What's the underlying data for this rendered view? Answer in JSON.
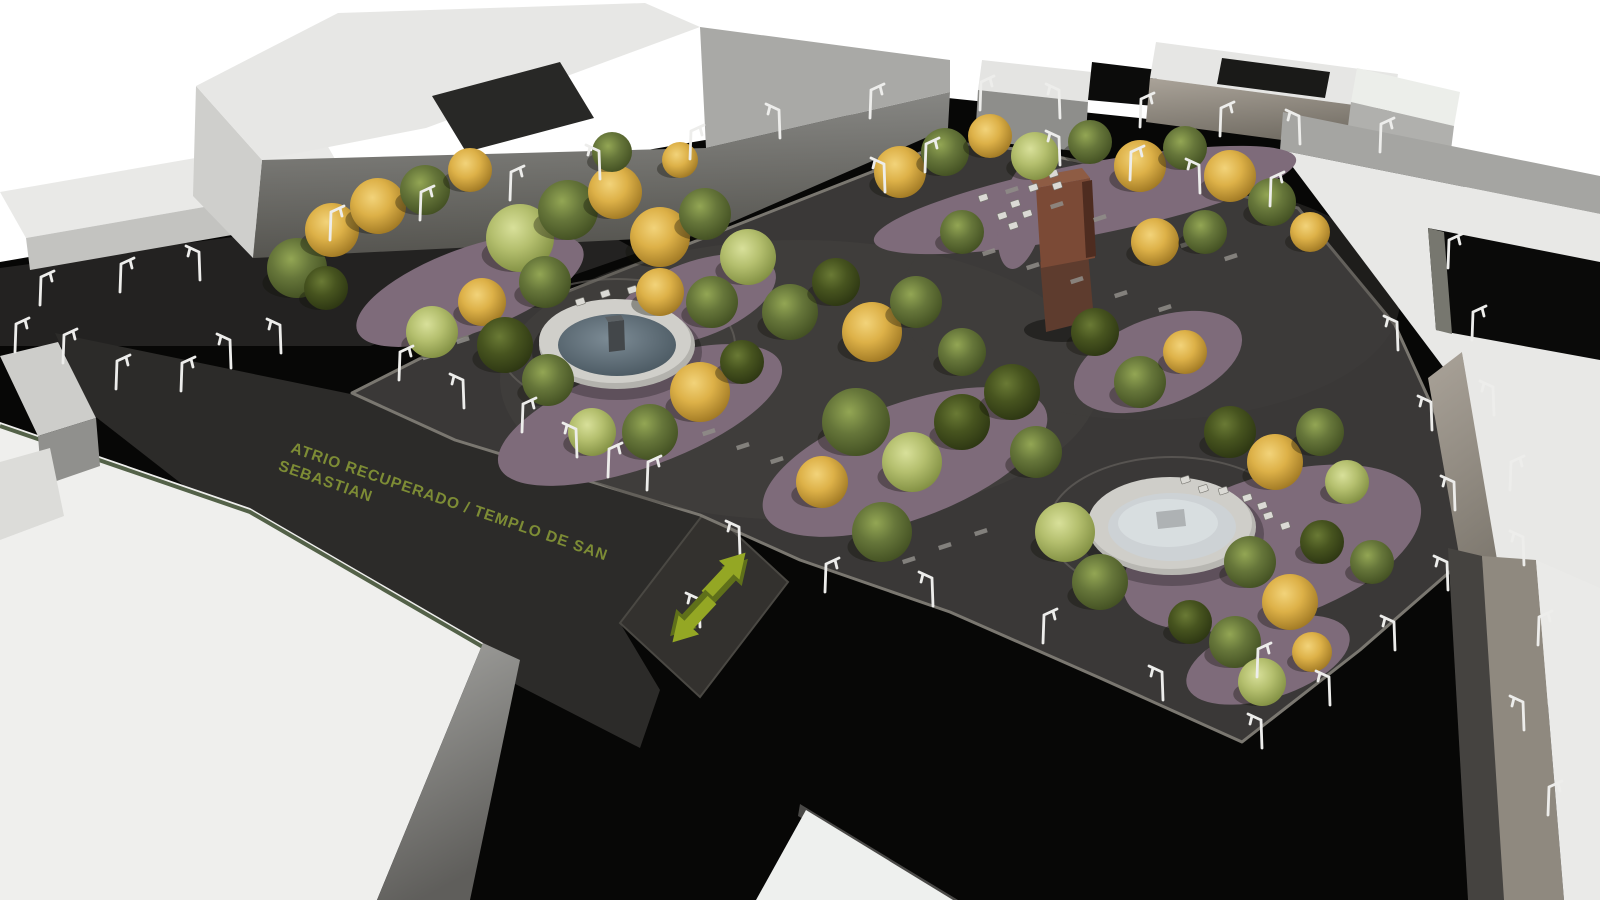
{
  "annotation": {
    "line1": "ATRIO RECUPERADO / TEMPLO DE SAN",
    "line2": "SEBASTIAN",
    "text_color": "#7d8c35"
  },
  "icons": {
    "arrow_up_right": "direction-arrow-northeast",
    "arrow_down_left": "direction-arrow-southwest",
    "street_lamp": "street-lamp"
  },
  "palette": {
    "background": "#ffffff",
    "street_asphalt": "#070706",
    "parking_surface": "#232221",
    "atrium_surface": "#2c2b29",
    "plaza_surface": "#3a3837",
    "crossing_surface": "#33312e",
    "curb_light": "#7a7770",
    "planting_bed": "#7e6b7a",
    "building_roof_white": "#eaeae8",
    "building_face_gray": "#8d8d8a",
    "building_face_taupe": "#9a948c",
    "fountain_rim": "#cfcec9",
    "fountain_water_blue": "#64737e",
    "fountain_water_white": "#cdd2d5",
    "monument_rust": "#7b4a36",
    "arrow_green": "#94a724",
    "arrow_green_dark": "#5f701a",
    "lamp_white": "#ededeb",
    "tree_gold": "#ddb148",
    "tree_green": "#66763a",
    "tree_light": "#b4bf6e",
    "tree_dark": "#47541f"
  },
  "scene": {
    "tree_palettes": {
      "G": {
        "c": "#66763a",
        "e": "#3f4c20",
        "h": "#93a654"
      },
      "Y": {
        "c": "#ddb148",
        "e": "#9a7320",
        "h": "#f2d37a"
      },
      "L": {
        "c": "#b4bf6e",
        "e": "#7c8a3e",
        "h": "#d8e09a"
      },
      "D": {
        "c": "#47541f",
        "e": "#2a3311",
        "h": "#6a7a35"
      }
    },
    "trees": [
      [
        297,
        268,
        30,
        "G"
      ],
      [
        332,
        230,
        27,
        "Y"
      ],
      [
        378,
        206,
        28,
        "Y"
      ],
      [
        326,
        288,
        22,
        "D"
      ],
      [
        425,
        190,
        25,
        "G"
      ],
      [
        470,
        170,
        22,
        "Y"
      ],
      [
        520,
        238,
        34,
        "L"
      ],
      [
        568,
        210,
        30,
        "G"
      ],
      [
        615,
        192,
        27,
        "Y"
      ],
      [
        660,
        237,
        30,
        "Y"
      ],
      [
        705,
        214,
        26,
        "G"
      ],
      [
        748,
        257,
        28,
        "L"
      ],
      [
        545,
        282,
        26,
        "G"
      ],
      [
        482,
        302,
        24,
        "Y"
      ],
      [
        432,
        332,
        26,
        "L"
      ],
      [
        612,
        152,
        20,
        "G"
      ],
      [
        680,
        160,
        18,
        "Y"
      ],
      [
        505,
        345,
        28,
        "D"
      ],
      [
        548,
        380,
        26,
        "G"
      ],
      [
        660,
        292,
        24,
        "Y"
      ],
      [
        712,
        302,
        26,
        "G"
      ],
      [
        700,
        392,
        30,
        "Y"
      ],
      [
        650,
        432,
        28,
        "G"
      ],
      [
        592,
        432,
        24,
        "L"
      ],
      [
        742,
        362,
        22,
        "D"
      ],
      [
        790,
        312,
        28,
        "G"
      ],
      [
        836,
        282,
        24,
        "D"
      ],
      [
        872,
        332,
        30,
        "Y"
      ],
      [
        916,
        302,
        26,
        "G"
      ],
      [
        856,
        422,
        34,
        "G"
      ],
      [
        912,
        462,
        30,
        "L"
      ],
      [
        962,
        422,
        28,
        "D"
      ],
      [
        822,
        482,
        26,
        "Y"
      ],
      [
        882,
        532,
        30,
        "G"
      ],
      [
        962,
        352,
        24,
        "G"
      ],
      [
        1012,
        392,
        28,
        "D"
      ],
      [
        1036,
        452,
        26,
        "G"
      ],
      [
        900,
        172,
        26,
        "Y"
      ],
      [
        945,
        152,
        24,
        "G"
      ],
      [
        990,
        136,
        22,
        "Y"
      ],
      [
        1035,
        156,
        24,
        "L"
      ],
      [
        1090,
        142,
        22,
        "G"
      ],
      [
        1140,
        166,
        26,
        "Y"
      ],
      [
        1185,
        148,
        22,
        "G"
      ],
      [
        1230,
        176,
        26,
        "Y"
      ],
      [
        1272,
        202,
        24,
        "G"
      ],
      [
        1310,
        232,
        20,
        "Y"
      ],
      [
        962,
        232,
        22,
        "G"
      ],
      [
        1155,
        242,
        24,
        "Y"
      ],
      [
        1205,
        232,
        22,
        "G"
      ],
      [
        1065,
        532,
        30,
        "L"
      ],
      [
        1100,
        582,
        28,
        "G"
      ],
      [
        1230,
        432,
        26,
        "D"
      ],
      [
        1275,
        462,
        28,
        "Y"
      ],
      [
        1320,
        432,
        24,
        "G"
      ],
      [
        1250,
        562,
        26,
        "G"
      ],
      [
        1290,
        602,
        28,
        "Y"
      ],
      [
        1322,
        542,
        22,
        "D"
      ],
      [
        1347,
        482,
        22,
        "L"
      ],
      [
        1235,
        642,
        26,
        "G"
      ],
      [
        1190,
        622,
        22,
        "D"
      ],
      [
        1262,
        682,
        24,
        "L"
      ],
      [
        1312,
        652,
        20,
        "Y"
      ],
      [
        1140,
        382,
        26,
        "G"
      ],
      [
        1185,
        352,
        22,
        "Y"
      ],
      [
        1095,
        332,
        24,
        "D"
      ],
      [
        1372,
        562,
        22,
        "G"
      ]
    ],
    "lamps": [
      [
        15,
        352,
        1
      ],
      [
        63,
        363,
        1
      ],
      [
        116,
        389,
        1
      ],
      [
        181,
        391,
        1
      ],
      [
        231,
        368,
        -1
      ],
      [
        281,
        353,
        -1
      ],
      [
        40,
        305,
        1
      ],
      [
        120,
        292,
        1
      ],
      [
        200,
        280,
        -1
      ],
      [
        330,
        240,
        1
      ],
      [
        420,
        220,
        1
      ],
      [
        510,
        200,
        1
      ],
      [
        600,
        179,
        -1
      ],
      [
        690,
        159,
        1
      ],
      [
        780,
        138,
        -1
      ],
      [
        870,
        118,
        1
      ],
      [
        980,
        110,
        1
      ],
      [
        1060,
        118,
        -1
      ],
      [
        1140,
        127,
        1
      ],
      [
        1220,
        136,
        1
      ],
      [
        1300,
        144,
        -1
      ],
      [
        1380,
        152,
        1
      ],
      [
        885,
        192,
        -1
      ],
      [
        925,
        172,
        1
      ],
      [
        1060,
        165,
        -1
      ],
      [
        1130,
        180,
        1
      ],
      [
        1200,
        193,
        -1
      ],
      [
        1270,
        206,
        1
      ],
      [
        1398,
        350,
        -1
      ],
      [
        1432,
        430,
        -1
      ],
      [
        1455,
        510,
        -1
      ],
      [
        1448,
        590,
        -1
      ],
      [
        1395,
        650,
        -1
      ],
      [
        1330,
        705,
        -1
      ],
      [
        1262,
        748,
        -1
      ],
      [
        1448,
        268,
        1
      ],
      [
        1472,
        340,
        1
      ],
      [
        1494,
        415,
        -1
      ],
      [
        1510,
        490,
        1
      ],
      [
        1524,
        565,
        -1
      ],
      [
        1538,
        645,
        1
      ],
      [
        1524,
        730,
        -1
      ],
      [
        1548,
        815,
        1
      ],
      [
        399,
        380,
        1
      ],
      [
        464,
        408,
        -1
      ],
      [
        522,
        432,
        1
      ],
      [
        577,
        457,
        -1
      ],
      [
        647,
        490,
        1
      ],
      [
        740,
        555,
        -1
      ],
      [
        825,
        592,
        1
      ],
      [
        933,
        606,
        -1
      ],
      [
        1043,
        643,
        1
      ],
      [
        1163,
        700,
        -1
      ],
      [
        1257,
        677,
        1
      ],
      [
        608,
        477,
        1
      ],
      [
        700,
        627,
        -1
      ]
    ],
    "benches": [
      [
        575,
        300
      ],
      [
        600,
        292
      ],
      [
        627,
        288
      ],
      [
        652,
        290
      ],
      [
        672,
        297
      ],
      [
        688,
        308
      ],
      [
        700,
        320
      ],
      [
        1180,
        478
      ],
      [
        1198,
        487
      ],
      [
        1218,
        489
      ],
      [
        1242,
        496
      ],
      [
        1257,
        504
      ],
      [
        1263,
        514
      ],
      [
        1280,
        524
      ],
      [
        1048,
        172
      ],
      [
        1052,
        184
      ],
      [
        1028,
        186
      ],
      [
        1010,
        202
      ],
      [
        1022,
        212
      ],
      [
        997,
        214
      ],
      [
        1008,
        224
      ],
      [
        978,
        196
      ]
    ],
    "dashes": [
      [
        1005,
        190
      ],
      [
        1050,
        205
      ],
      [
        1093,
        218
      ],
      [
        1136,
        231
      ],
      [
        1180,
        244
      ],
      [
        1224,
        257
      ],
      [
        982,
        252
      ],
      [
        1026,
        266
      ],
      [
        1070,
        280
      ],
      [
        1114,
        294
      ],
      [
        1158,
        308
      ],
      [
        422,
        356
      ],
      [
        456,
        340
      ],
      [
        490,
        324
      ],
      [
        702,
        432
      ],
      [
        736,
        446
      ],
      [
        770,
        460
      ],
      [
        902,
        560
      ],
      [
        938,
        546
      ],
      [
        974,
        532
      ]
    ]
  }
}
